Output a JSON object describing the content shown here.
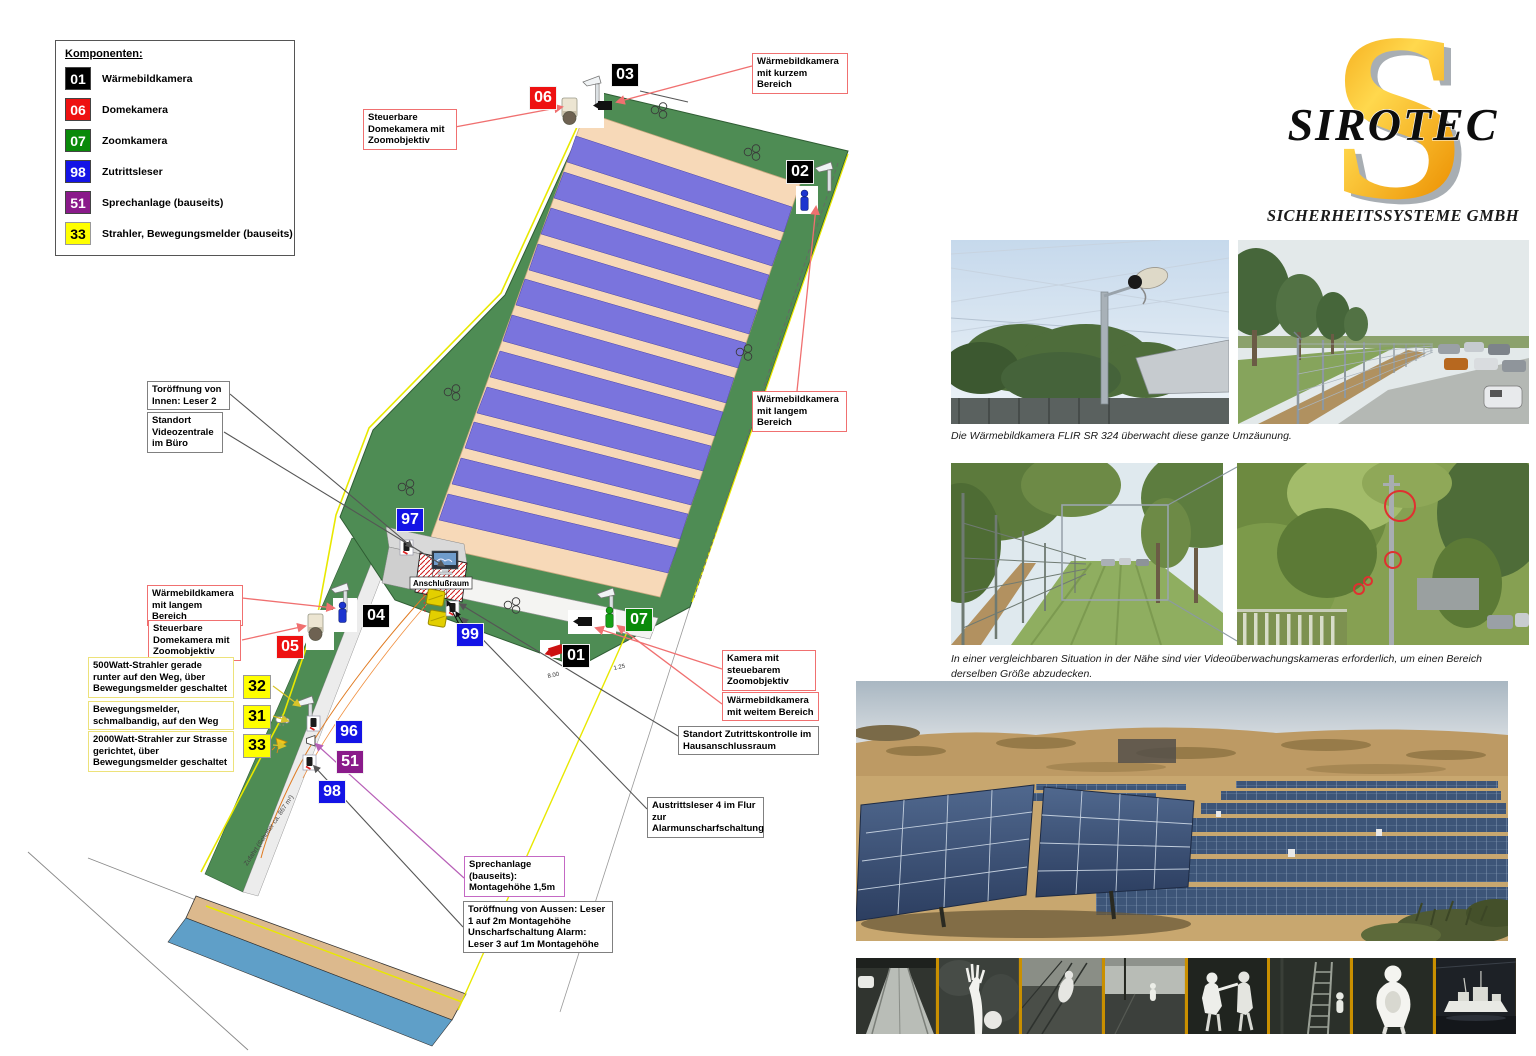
{
  "legend": {
    "title": "Komponenten:",
    "items": [
      {
        "code": "01",
        "color": "#000000",
        "text_color": "#ffffff",
        "label": "Wärmebildkamera"
      },
      {
        "code": "06",
        "color": "#ee1111",
        "text_color": "#ffffff",
        "label": "Domekamera"
      },
      {
        "code": "07",
        "color": "#0a8a0a",
        "text_color": "#ffffff",
        "label": "Zoomkamera"
      },
      {
        "code": "98",
        "color": "#1414e6",
        "text_color": "#ffffff",
        "label": "Zutrittsleser"
      },
      {
        "code": "51",
        "color": "#8a1a8a",
        "text_color": "#ffffff",
        "label": "Sprechanlage (bauseits)"
      },
      {
        "code": "33",
        "color": "#ffff00",
        "text_color": "#000000",
        "label": "Strahler, Bewegungsmelder (bauseits)"
      }
    ]
  },
  "plan": {
    "badges": [
      {
        "code": "03",
        "color": "#000000"
      },
      {
        "code": "06",
        "color": "#ee1111"
      },
      {
        "code": "02",
        "color": "#000000"
      },
      {
        "code": "97",
        "color": "#1414e6"
      },
      {
        "code": "04",
        "color": "#000000"
      },
      {
        "code": "05",
        "color": "#ee1111"
      },
      {
        "code": "99",
        "color": "#1414e6"
      },
      {
        "code": "01",
        "color": "#000000"
      },
      {
        "code": "07",
        "color": "#0a8a0a"
      },
      {
        "code": "32",
        "color": "#ffff00"
      },
      {
        "code": "31",
        "color": "#ffff00"
      },
      {
        "code": "33",
        "color": "#ffff00"
      },
      {
        "code": "96",
        "color": "#1414e6"
      },
      {
        "code": "51",
        "color": "#8a1a8a"
      },
      {
        "code": "98",
        "color": "#1414e6"
      }
    ],
    "callouts": [
      {
        "style": "red",
        "text": "Wärmebildkamera mit kurzem Bereich"
      },
      {
        "style": "red",
        "text": "Steuerbare Domekamera mit Zoomobjektiv"
      },
      {
        "style": "red",
        "text": "Wärmebildkamera mit langem Bereich"
      },
      {
        "style": "gray",
        "text": "Toröffnung von Innen: Leser 2"
      },
      {
        "style": "gray",
        "text": "Standort Videozentrale im Büro"
      },
      {
        "style": "red",
        "text": "Wärmebildkamera mit langem Bereich"
      },
      {
        "style": "red",
        "text": "Steuerbare Domekamera mit Zoomobjektiv"
      },
      {
        "style": "yellow",
        "text": "500Watt-Strahler gerade runter auf den Weg, über Bewegungsmelder geschaltet"
      },
      {
        "style": "yellow",
        "text": "Bewegungsmelder, schmalbandig, auf den Weg"
      },
      {
        "style": "yellow",
        "text": "2000Watt-Strahler zur Strasse gerichtet, über Bewegungsmelder geschaltet"
      },
      {
        "style": "red",
        "text": "Kamera mit steuebarem Zoomobjektiv"
      },
      {
        "style": "red",
        "text": "Wärmebildkamera mit weitem Bereich"
      },
      {
        "style": "gray",
        "text": "Standort Zutrittskontrolle im Hausanschlussraum"
      },
      {
        "style": "gray",
        "text": "Austrittsleser 4 im Flur zur Alarmunscharfschaltung"
      },
      {
        "style": "purple",
        "text": "Sprechanlage (bauseits): Montagehöhe 1,5m"
      },
      {
        "style": "gray",
        "text": "Toröffnung von Aussen: Leser 1 auf 2m Montagehöhe Unscharfschaltung Alarm: Leser 3 auf 1m Montagehöhe"
      }
    ],
    "labels": {
      "anschlussraum": "Anschlußraum",
      "zufahrt": "Zufahrt (Schotter ca. 867 m²)",
      "dim_a": "8.00",
      "dim_b": "1.25"
    }
  },
  "logo": {
    "letter": "S",
    "name": "SIROTEC",
    "subtitle": "SICHERHEITSSYSTEME GMBH",
    "orange": "#f6a500"
  },
  "captions": {
    "flir": "Die Wärmebildkamera FLIR SR 324 überwacht diese ganze Umzäunung.",
    "vergleich": "In einer vergleichbaren Situation in der Nähe sind vier Videoüberwachungskameras erforderlich, um einen Bereich derselben Größe abzudecken."
  },
  "colors": {
    "field_green": "#4e8c54",
    "panel_blue": "#7a74dd",
    "panel_bed_peach": "#f7d9b8",
    "boundary_yellow": "#e8e800",
    "road_tan": "#dcb98d",
    "water_blue": "#5f9fc8",
    "callout_red": "#f07070",
    "callout_gray": "#808080",
    "callout_yellow": "#ede27a",
    "callout_purple": "#c468c4",
    "strip_separator": "#c98f00"
  }
}
